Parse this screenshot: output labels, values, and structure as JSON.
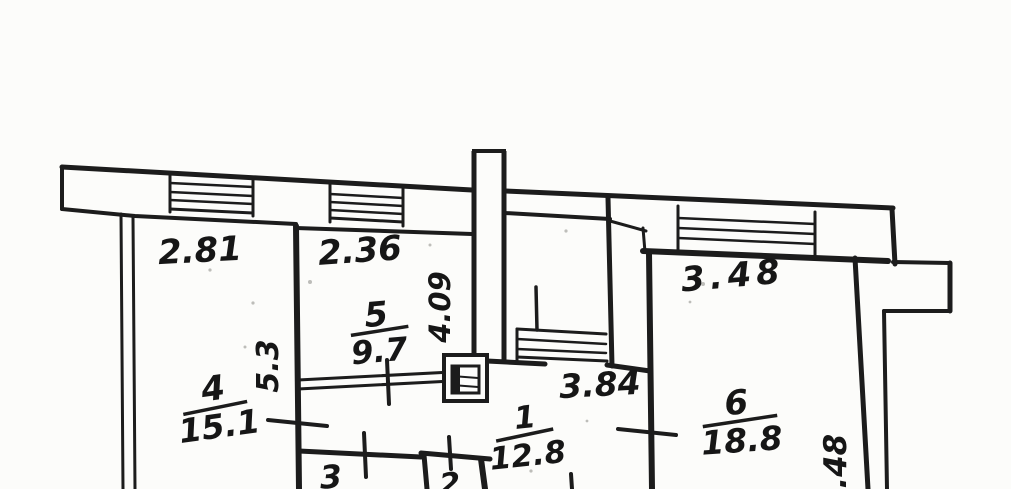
{
  "plan": {
    "rooms": [
      {
        "id": "room-4",
        "number": "4",
        "area": "15.1",
        "top_dimension": "2.81",
        "side_dimension": "5.3"
      },
      {
        "id": "room-5",
        "number": "5",
        "area": "9.7",
        "top_dimension": "2.36",
        "side_dimension": "4.09"
      },
      {
        "id": "room-6",
        "number": "6",
        "area": "18.8",
        "top_dimension": "3.48",
        "side_dimension": "5.48"
      },
      {
        "id": "room-1",
        "number": "1",
        "area": "12.8"
      },
      {
        "id": "room-3",
        "number": "3"
      },
      {
        "id": "room-2",
        "number": "2"
      }
    ],
    "other_dimensions": {
      "center_bay_width": "3.84"
    }
  },
  "colors": {
    "ink": "#1c1c1c",
    "paper": "#fcfcfa"
  }
}
